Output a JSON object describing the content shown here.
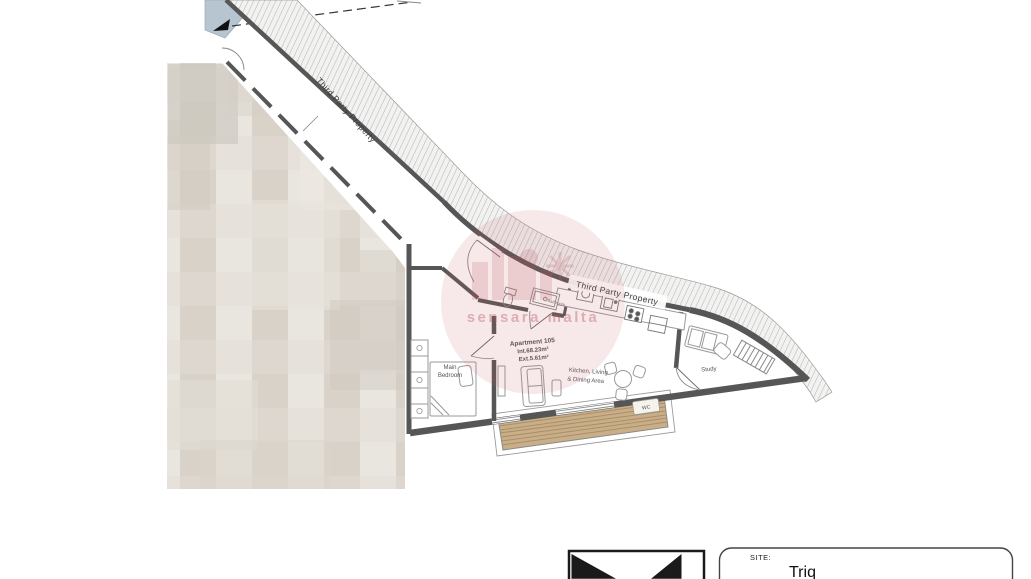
{
  "annotations": {
    "party_wall_diagonal": "Third Party Property",
    "party_wall_top": "Third Party Property"
  },
  "apartment": {
    "title": "Apartment 105",
    "internal_area": "Int.68.23m²",
    "external_area": "Ext.5.61m²"
  },
  "rooms": {
    "main_bedroom_line1": "Main",
    "main_bedroom_line2": "Bedroom",
    "kitchen_line1": "Kitchen, Living",
    "kitchen_line2": "& Dining Area",
    "study": "Study",
    "bathroom": "Bathroom",
    "wc_label": "WC"
  },
  "watermark": {
    "text": "sensara malta"
  },
  "title_block": {
    "site_label": "SITE:",
    "site_value": "Triq"
  },
  "colors": {
    "wall": "#565656",
    "deck": "#c9ae87",
    "neighbour_blue": "#b7c5d1",
    "watermark_pink": "#c4636c"
  }
}
